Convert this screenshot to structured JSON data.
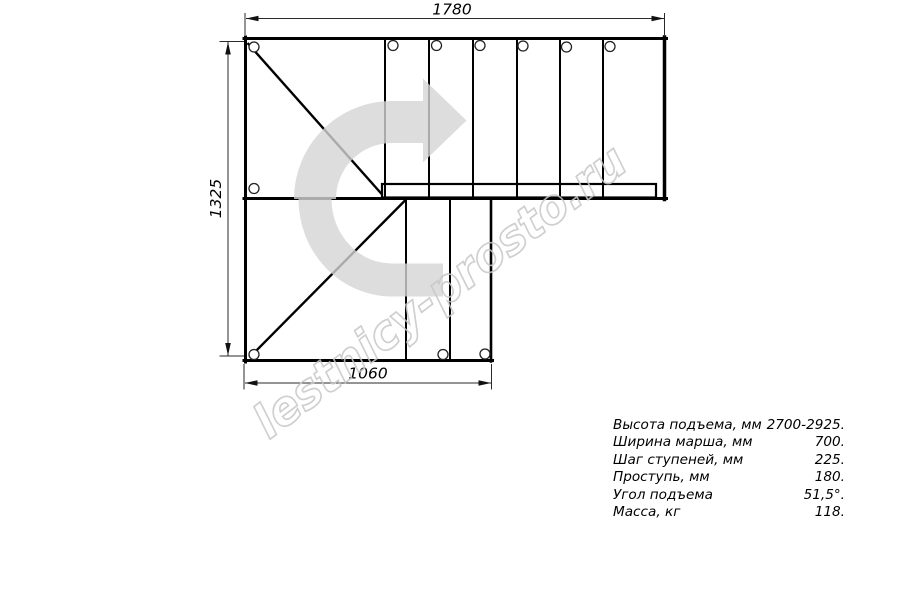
{
  "page": {
    "type": "stair-plan-technical-drawing"
  },
  "drawing": {
    "dim_top": "1780",
    "dim_left": "1325",
    "dim_bottom": "1060"
  },
  "watermark": {
    "text": "lestnicy-prosto.ru"
  },
  "colors": {
    "line": "#000000",
    "dim_line": "#2a2a2a",
    "arrow": "#d5d5d5",
    "watermark": "#c7c7c7"
  },
  "specs": {
    "rows": [
      {
        "label": "Высота подъема, мм",
        "value": "2700-2925."
      },
      {
        "label": "Ширина марша, мм",
        "value": "700."
      },
      {
        "label": "Шаг ступеней, мм",
        "value": "225."
      },
      {
        "label": "Проступь, мм",
        "value": "180."
      },
      {
        "label": "Угол подъема",
        "value": "51,5°."
      },
      {
        "label": "Масса, кг",
        "value": "118."
      }
    ]
  }
}
